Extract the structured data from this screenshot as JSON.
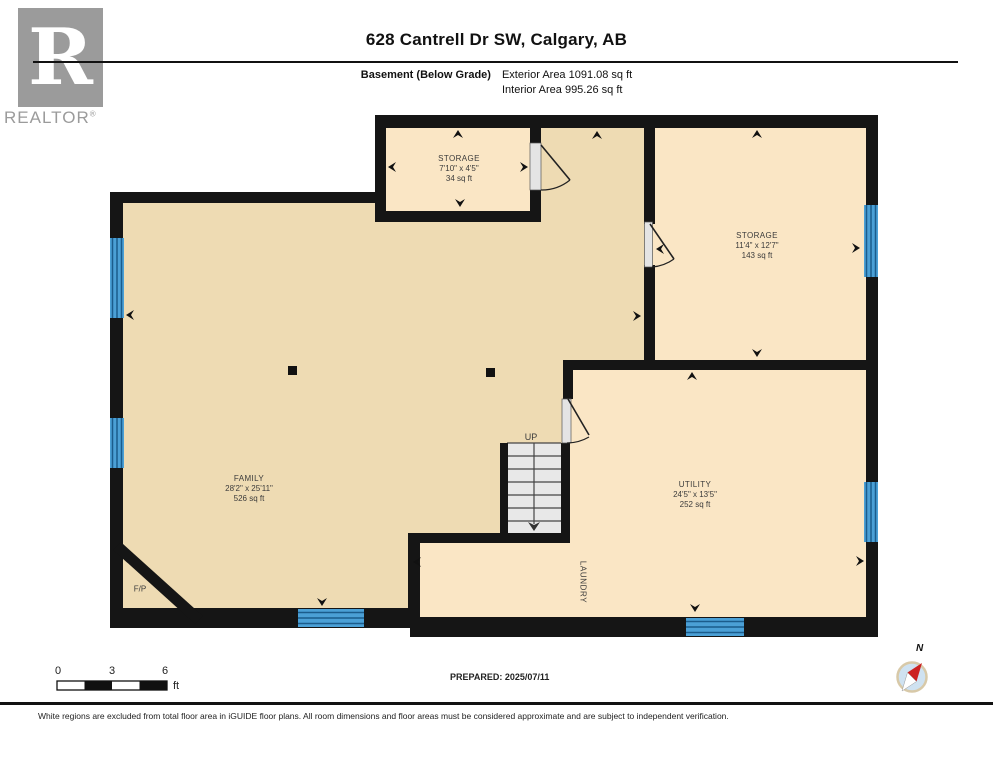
{
  "header": {
    "title": "628 Cantrell Dr SW, Calgary, AB",
    "floor_label": "Basement (Below Grade)",
    "exterior_area": "Exterior Area 1091.08 sq ft",
    "interior_area": "Interior Area 995.26 sq ft"
  },
  "logo": {
    "letter": "R",
    "word": "REALTOR",
    "registered": "®"
  },
  "rooms": {
    "storage_top": {
      "name": "STORAGE",
      "dims": "7'10\" x 4'5\"",
      "area": "34 sq ft"
    },
    "storage_right": {
      "name": "STORAGE",
      "dims": "11'4\" x 12'7\"",
      "area": "143 sq ft"
    },
    "family": {
      "name": "FAMILY",
      "dims": "28'2\" x 25'11\"",
      "area": "526 sq ft"
    },
    "utility": {
      "name": "UTILITY",
      "dims": "24'5\" x 13'5\"",
      "area": "252 sq ft"
    },
    "laundry": {
      "name": "LAUNDRY"
    },
    "fireplace": {
      "name": "F/P"
    },
    "stairs": {
      "label": "UP"
    }
  },
  "scale_bar": {
    "tick0": "0",
    "tick3": "3",
    "tick6": "6",
    "unit": "ft"
  },
  "prepared": "PREPARED: 2025/07/11",
  "compass": {
    "north": "N"
  },
  "footer": "White regions are excluded from total floor area in iGUIDE floor plans. All room dimensions and floor areas must be considered approximate and are subject to independent verification.",
  "colors": {
    "floor_main": "#eedbb3",
    "floor_light": "#fae6c5",
    "wall": "#151515",
    "window_fill": "#4ba0d6",
    "window_stripe": "#1b5c8c",
    "stair_fill": "#e8e8e8",
    "door_panel": "#e4e4e4",
    "logo_gray": "#9b9b9b",
    "compass_blue": "#cfe2f1",
    "compass_red": "#cc2222"
  }
}
